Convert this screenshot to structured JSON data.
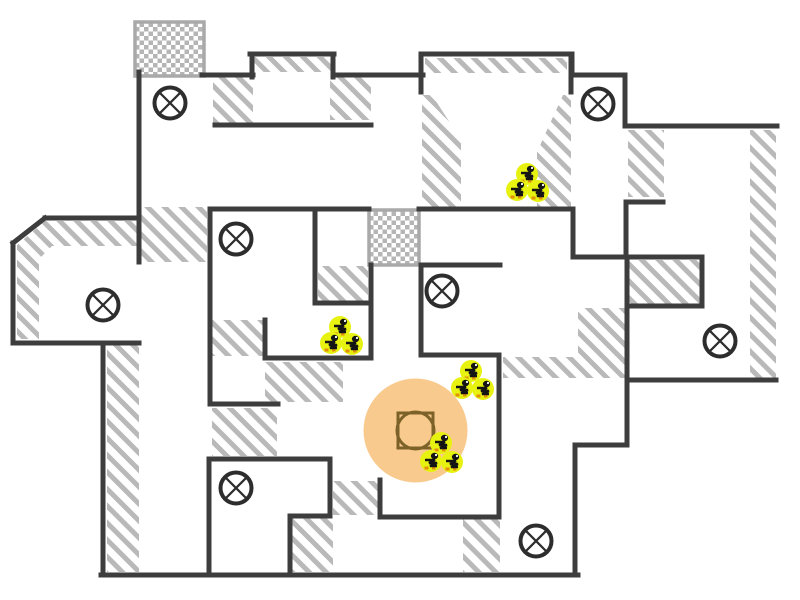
{
  "canvas": {
    "width": 800,
    "height": 600,
    "background": "#ffffff"
  },
  "palette": {
    "wall": "#3d3d3d",
    "hatch_line": "#b9b9b9",
    "checker_cell": "#b5b5b5",
    "checker_border": "#a9a9a9",
    "symbol_stroke": "#2d2d2d",
    "zone_fill": "#f9ca8d",
    "zone_marker_stroke": "#7c6228",
    "unit_fill": "#e8f211",
    "unit_glyph": "#141414",
    "unit_accent": "#e2900a",
    "unit_eye": "#ffffff"
  },
  "floor_plan": {
    "walls": [
      [
        139,
        72,
        139,
        262
      ],
      [
        202,
        75,
        253,
        75
      ],
      [
        252,
        54,
        252,
        77
      ],
      [
        250,
        54,
        334,
        54
      ],
      [
        333,
        54,
        333,
        77
      ],
      [
        333,
        75,
        423,
        75
      ],
      [
        215,
        125,
        371,
        125
      ],
      [
        210,
        209,
        369,
        209
      ],
      [
        419,
        209,
        572,
        209
      ],
      [
        315,
        209,
        315,
        303
      ],
      [
        315,
        303,
        371,
        303
      ],
      [
        371,
        265,
        371,
        358
      ],
      [
        265,
        358,
        371,
        358
      ],
      [
        265,
        320,
        265,
        358
      ],
      [
        210,
        209,
        210,
        404
      ],
      [
        210,
        404,
        278,
        404
      ],
      [
        421,
        265,
        500,
        265
      ],
      [
        421,
        265,
        421,
        355
      ],
      [
        421,
        355,
        498,
        355
      ],
      [
        499,
        355,
        499,
        517
      ],
      [
        380,
        517,
        499,
        517
      ],
      [
        380,
        480,
        380,
        517
      ],
      [
        209,
        459,
        330,
        459
      ],
      [
        209,
        459,
        209,
        575
      ],
      [
        330,
        459,
        330,
        516
      ],
      [
        290,
        516,
        330,
        516
      ],
      [
        290,
        516,
        290,
        575
      ],
      [
        101,
        575,
        578,
        575
      ],
      [
        103,
        343,
        103,
        575
      ],
      [
        13,
        343,
        139,
        343
      ],
      [
        13,
        243,
        13,
        343
      ],
      [
        13,
        243,
        45,
        218
      ],
      [
        45,
        218,
        139,
        218
      ],
      [
        575,
        445,
        575,
        575
      ],
      [
        575,
        445,
        627,
        445
      ],
      [
        627,
        380,
        627,
        445
      ],
      [
        627,
        380,
        776,
        380
      ],
      [
        627,
        257,
        627,
        380
      ],
      [
        627,
        306,
        702,
        306
      ],
      [
        702,
        257,
        702,
        306
      ],
      [
        573,
        257,
        702,
        257
      ],
      [
        573,
        209,
        573,
        257
      ],
      [
        627,
        202,
        663,
        202
      ],
      [
        626,
        202,
        626,
        257
      ],
      [
        625,
        75,
        625,
        126
      ],
      [
        572,
        75,
        625,
        75
      ],
      [
        572,
        54,
        572,
        75
      ],
      [
        421,
        54,
        572,
        54
      ],
      [
        421,
        54,
        421,
        92
      ],
      [
        571,
        54,
        571,
        92
      ],
      [
        625,
        126,
        777,
        126
      ]
    ],
    "hatch_areas": [
      [
        [
          141,
          207
        ],
        [
          207,
          207
        ],
        [
          207,
          262
        ],
        [
          141,
          262
        ]
      ],
      [
        [
          17,
          245
        ],
        [
          45,
          221
        ],
        [
          137,
          221
        ],
        [
          137,
          246
        ],
        [
          52,
          246
        ],
        [
          39,
          259
        ],
        [
          39,
          339
        ],
        [
          17,
          339
        ]
      ],
      [
        [
          107,
          345
        ],
        [
          139,
          345
        ],
        [
          139,
          572
        ],
        [
          107,
          572
        ]
      ],
      [
        [
          213,
          77
        ],
        [
          253,
          77
        ],
        [
          253,
          123
        ],
        [
          213,
          123
        ]
      ],
      [
        [
          253,
          57
        ],
        [
          331,
          57
        ],
        [
          331,
          72
        ],
        [
          253,
          72
        ]
      ],
      [
        [
          330,
          77
        ],
        [
          371,
          77
        ],
        [
          371,
          120
        ],
        [
          330,
          120
        ]
      ],
      [
        [
          425,
          58
        ],
        [
          567,
          58
        ],
        [
          567,
          73
        ],
        [
          425,
          73
        ]
      ],
      [
        [
          422,
          95
        ],
        [
          432,
          95
        ],
        [
          461,
          140
        ],
        [
          461,
          207
        ],
        [
          422,
          207
        ]
      ],
      [
        [
          563,
          95
        ],
        [
          571,
          95
        ],
        [
          571,
          207
        ],
        [
          537,
          207
        ],
        [
          537,
          152
        ]
      ],
      [
        [
          628,
          130
        ],
        [
          664,
          130
        ],
        [
          664,
          197
        ],
        [
          628,
          197
        ]
      ],
      [
        [
          750,
          130
        ],
        [
          776,
          130
        ],
        [
          776,
          378
        ],
        [
          750,
          378
        ]
      ],
      [
        [
          629,
          260
        ],
        [
          702,
          260
        ],
        [
          702,
          304
        ],
        [
          629,
          304
        ]
      ],
      [
        [
          318,
          266
        ],
        [
          368,
          266
        ],
        [
          368,
          302
        ],
        [
          318,
          302
        ]
      ],
      [
        [
          212,
          320
        ],
        [
          263,
          320
        ],
        [
          263,
          356
        ],
        [
          212,
          356
        ]
      ],
      [
        [
          265,
          362
        ],
        [
          343,
          362
        ],
        [
          343,
          402
        ],
        [
          265,
          402
        ]
      ],
      [
        [
          212,
          408
        ],
        [
          277,
          408
        ],
        [
          277,
          456
        ],
        [
          212,
          456
        ]
      ],
      [
        [
          333,
          481
        ],
        [
          378,
          481
        ],
        [
          378,
          515
        ],
        [
          333,
          515
        ]
      ],
      [
        [
          292,
          518
        ],
        [
          333,
          518
        ],
        [
          333,
          572
        ],
        [
          292,
          572
        ]
      ],
      [
        [
          463,
          518
        ],
        [
          500,
          518
        ],
        [
          500,
          572
        ],
        [
          463,
          572
        ]
      ],
      [
        [
          578,
          308
        ],
        [
          627,
          308
        ],
        [
          627,
          378
        ],
        [
          503,
          378
        ],
        [
          503,
          357
        ],
        [
          578,
          357
        ]
      ]
    ],
    "checkered_zones": [
      {
        "x": 135,
        "y": 22,
        "w": 69,
        "h": 54
      },
      {
        "x": 369,
        "y": 210,
        "w": 50,
        "h": 55
      }
    ],
    "circled_x_markers": [
      {
        "x": 170,
        "y": 103
      },
      {
        "x": 598,
        "y": 104
      },
      {
        "x": 236,
        "y": 239
      },
      {
        "x": 442,
        "y": 291
      },
      {
        "x": 103,
        "y": 305
      },
      {
        "x": 720,
        "y": 341
      },
      {
        "x": 236,
        "y": 488
      },
      {
        "x": 536,
        "y": 541
      }
    ],
    "unit_clusters": [
      {
        "units": [
          [
            527,
            174
          ],
          [
            517,
            190
          ],
          [
            538,
            191
          ]
        ]
      },
      {
        "units": [
          [
            340,
            327
          ],
          [
            331,
            343
          ],
          [
            352,
            344
          ]
        ]
      },
      {
        "units": [
          [
            471,
            371
          ],
          [
            462,
            388
          ],
          [
            483,
            389
          ]
        ]
      },
      {
        "units": [
          [
            441,
            443
          ],
          [
            431,
            461
          ],
          [
            452,
            462
          ]
        ]
      }
    ],
    "objective_zone": {
      "cx": 415.5,
      "cy": 430.5,
      "radius": 52,
      "square": {
        "x": 398,
        "y": 413,
        "size": 35
      },
      "inner_circle_radius": 18.5
    }
  }
}
